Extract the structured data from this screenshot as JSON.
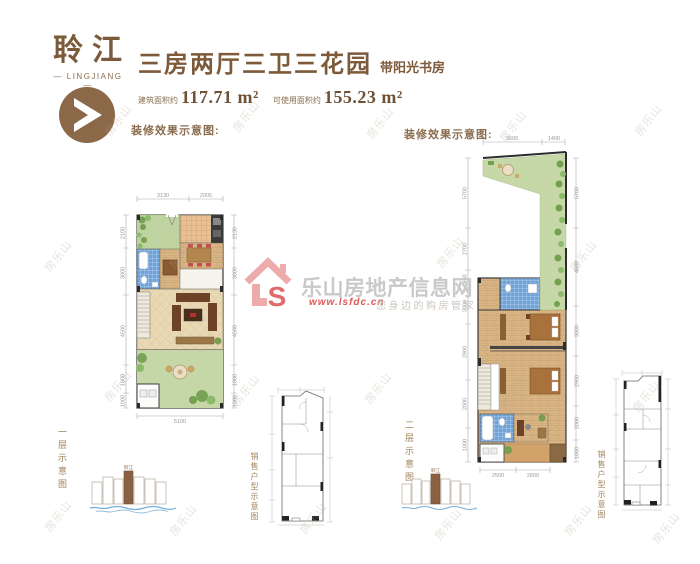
{
  "header": {
    "brand": "聆江",
    "brand_en": "— LINGJIANG —",
    "title": "三房两厅三卫三花园",
    "title_suffix": "带阳光书房",
    "area_built_label": "建筑面积约",
    "area_built_value": "117.71 m²",
    "area_usable_label": "可使用面积约",
    "area_usable_value": "155.23 m²"
  },
  "captions": {
    "left_render": "装修效果示意图:",
    "right_render": "装修效果示意图:",
    "first_floor": "一层示意图",
    "second_floor": "二层示意图",
    "sales_left": "销售户型示意图",
    "sales_right": "销售户型示意图"
  },
  "left_plan": {
    "dims_top": [
      "3130",
      "2005"
    ],
    "dims_left": [
      "2100",
      "3000",
      "4500",
      "1800",
      "1000"
    ],
    "dims_right": [
      "2130",
      "3000",
      "4500",
      "1800",
      "1500"
    ],
    "dims_bottom": [
      "5100"
    ]
  },
  "right_plan": {
    "dims_top": [
      "3600",
      "1400"
    ],
    "dims_left": [
      "5700",
      "2700",
      "900",
      "3000",
      "2900",
      "2000",
      "1000"
    ],
    "dims_right": [
      "5700",
      "4600",
      "3000",
      "2900",
      "2000",
      "1000"
    ],
    "dims_bottom": [
      "2500",
      "2800"
    ]
  },
  "elevation": {
    "tower_label": "聆江"
  },
  "watermark": {
    "site_name": "乐山房地产信息网",
    "site_url": "www.lsfdc.cn",
    "slogan": "您身边的购房管家",
    "logo_letter": "S",
    "tile_text": "房乐山"
  },
  "colors": {
    "brand_brown": "#7d5a3a",
    "heading_brown": "#8a6d4e",
    "dim_gray": "#9a9a9a",
    "garden_green": "#c3d6a4",
    "terrace_green": "#c6d8a8",
    "tile_blue": "#6fa3d8",
    "wood_tan": "#d9b586",
    "watermark_gray": "#c9c9c9",
    "logo_pink": "#eeabab",
    "logo_red": "#e06a6a",
    "water_blue": "#74aed6",
    "elevation_brown": "#8a6243"
  }
}
